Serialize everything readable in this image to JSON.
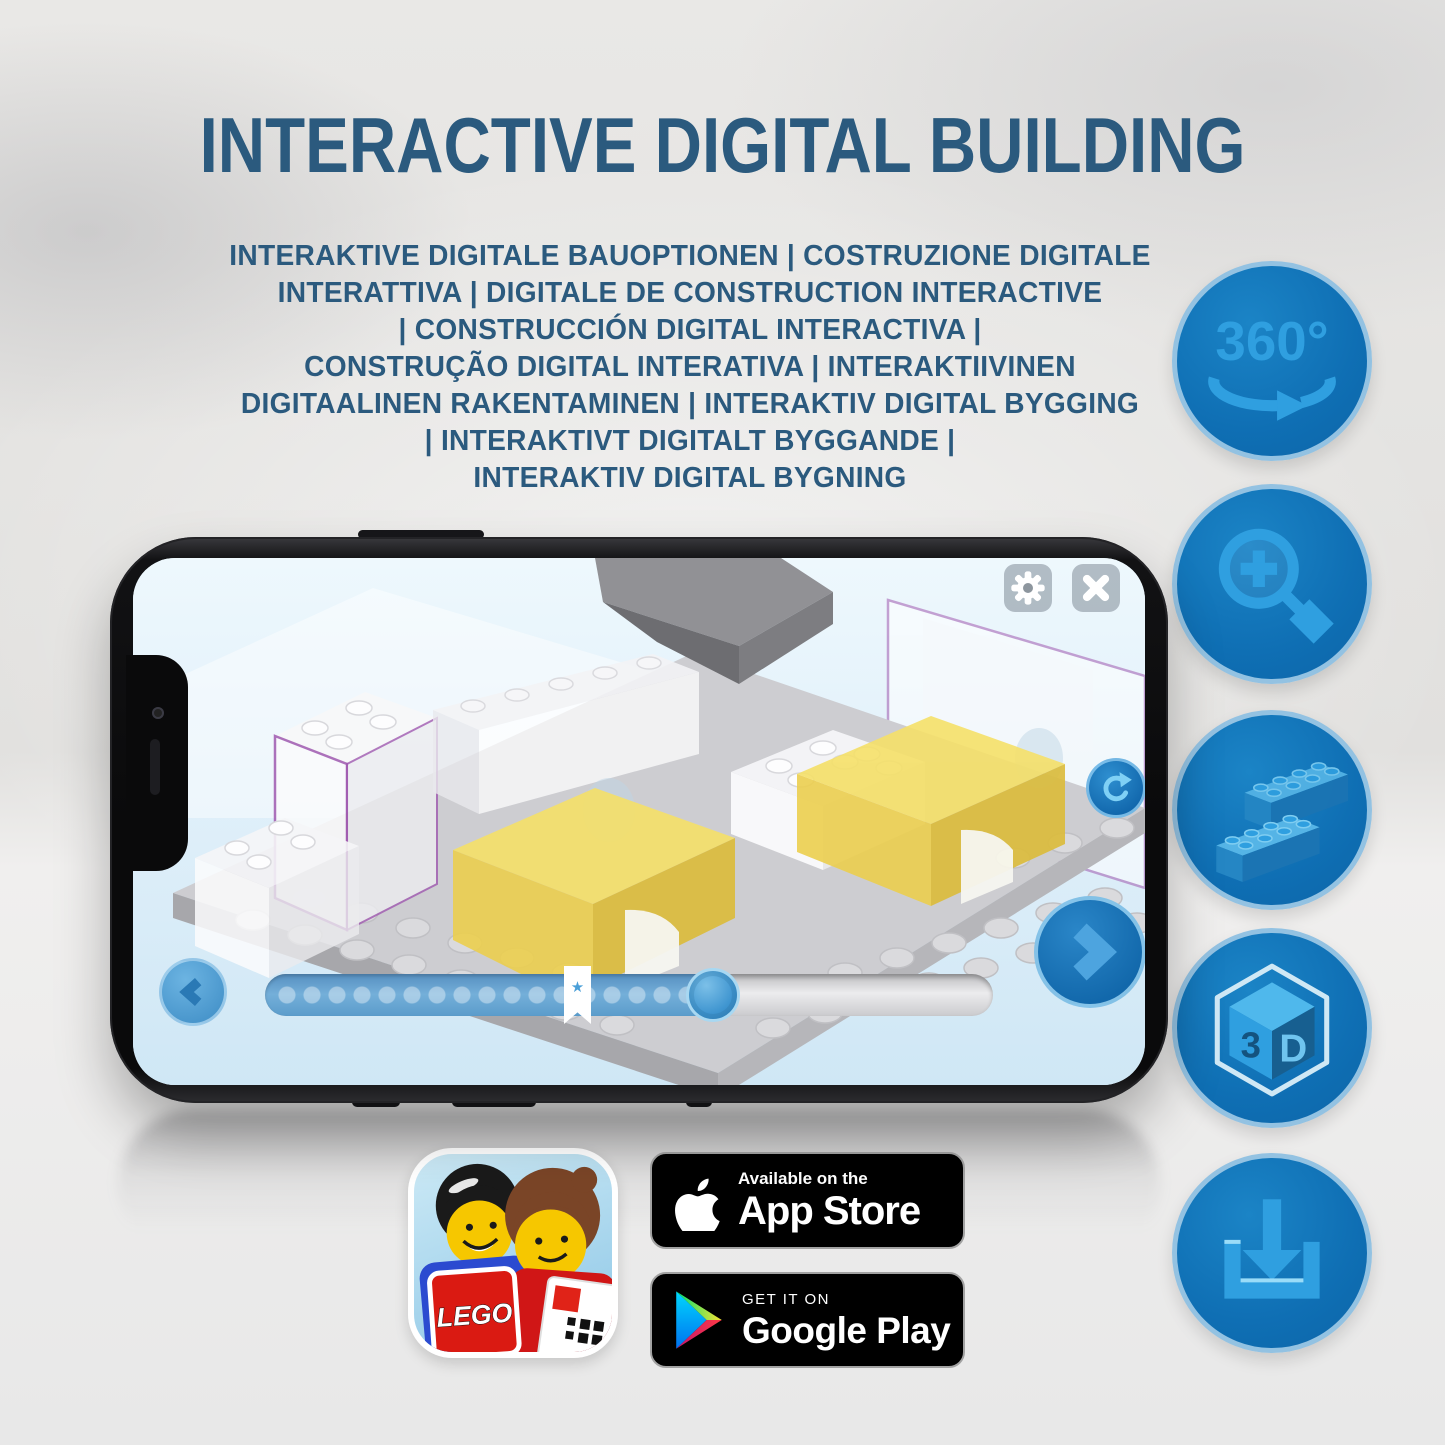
{
  "title": "INTERACTIVE DIGITAL BUILDING",
  "subtitle": "INTERAKTIVE DIGITALE BAUOPTIONEN | COSTRUZIONE DIGITALE\nINTERATTIVA | DIGITALE DE CONSTRUCTION INTERACTIVE\n| CONSTRUCCIÓN DIGITAL INTERACTIVA |\nCONSTRUÇÃO DIGITAL INTERATIVA | INTERAKTIIVINEN\nDIGITAALINEN RAKENTAMINEN | INTERAKTIV DIGITAL BYGGING\n| INTERAKTIVT DIGITALT BYGGANDE |\nINTERAKTIV DIGITAL BYGNING",
  "feature_icons": {
    "rotation_360": {
      "label": "360°"
    },
    "three_d": {
      "label_left": "3",
      "label_right": "D"
    }
  },
  "phone": {
    "slider": {
      "progress_percent": 62,
      "bookmark_percent": 43,
      "star_glyph": "★"
    }
  },
  "badges": {
    "app_store": {
      "tagline": "Available on the",
      "store_name": "App Store"
    },
    "google_play": {
      "tagline": "GET IT ON",
      "store_name": "Google Play"
    },
    "lego_app": {
      "logo_text": "LEGO"
    }
  },
  "colors": {
    "heading_blue": "#2b5a7e",
    "icon_circle_blue": "#1173b8",
    "icon_glyph_blue": "#2f9fe0",
    "screen_button_blue": "#3b97d3"
  }
}
